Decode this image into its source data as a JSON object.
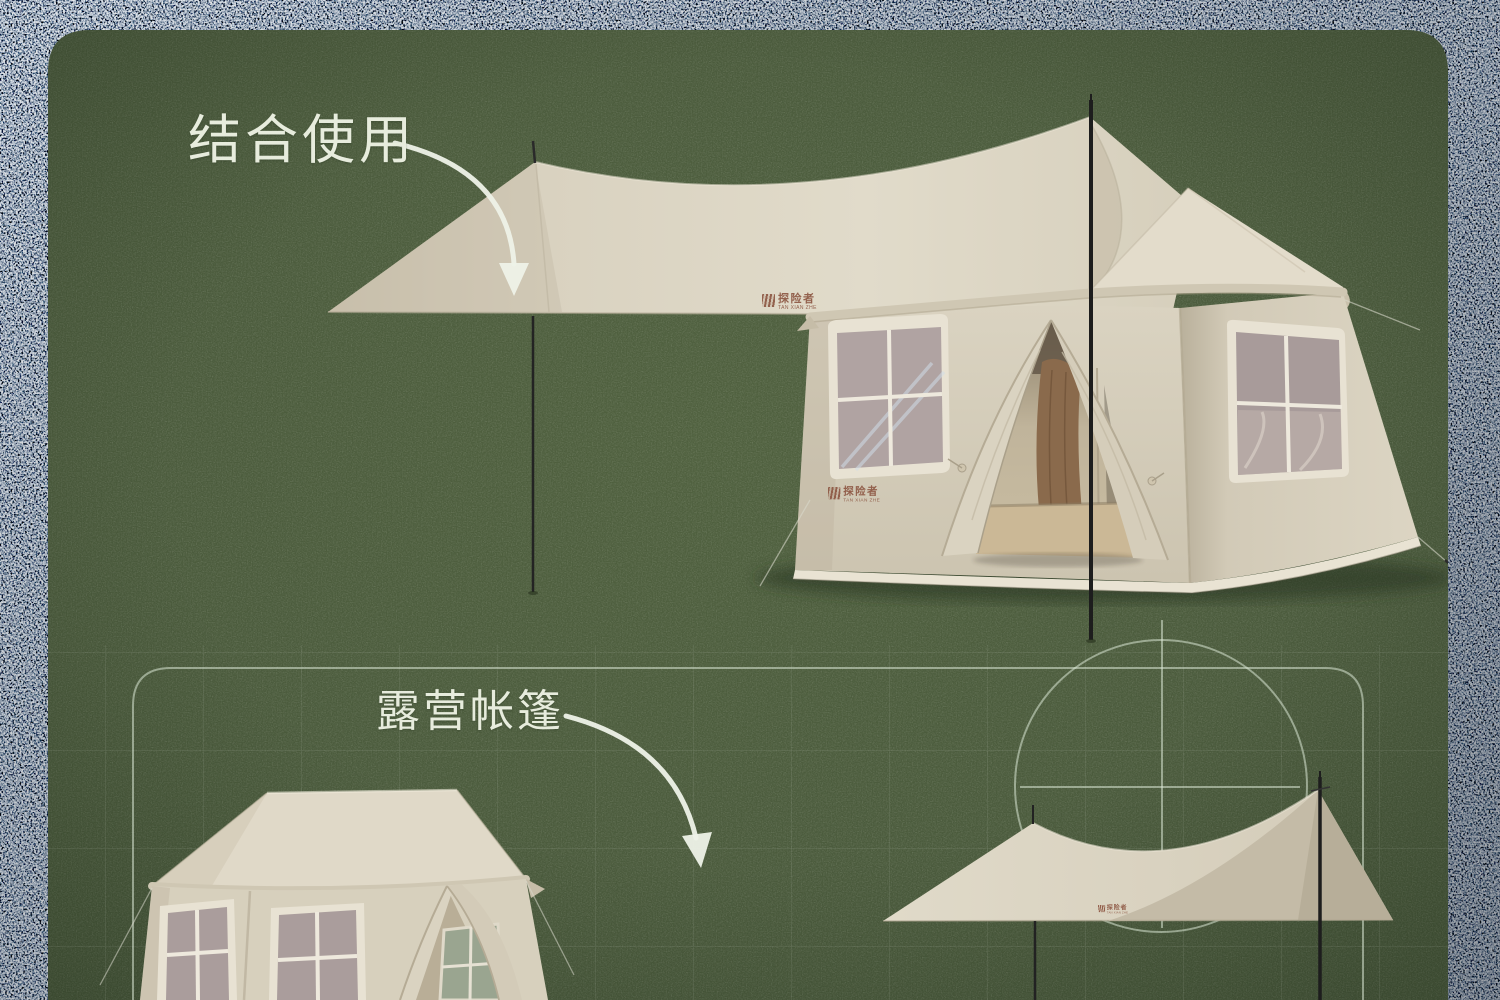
{
  "canvas": {
    "width": 1500,
    "height": 1000
  },
  "annotations": {
    "top_label": "结合使用",
    "bottom_label": "露营帐篷"
  },
  "brand": {
    "name": "探险者",
    "latin": "TAN XIAN ZHE"
  },
  "style": {
    "gravel_border": "#3a444c",
    "panel_green": "#4a5a3c",
    "fabric_light": "#e2dbca",
    "fabric_mid": "#d7d0be",
    "fabric_shadow": "#bfb6a1",
    "window_mesh": "#aca09f",
    "blueprint_line": "#dbe7d6",
    "pole": "#1d1d1d",
    "label_text": "#e7ecdd",
    "logo_color": "#8d5743"
  },
  "scenes": {
    "top": "tarp pitched over lodge cabin tent",
    "bottom_left": "lodge tent close-up (cropped)",
    "bottom_right": "flat canopy tarp over blueprint circle"
  }
}
